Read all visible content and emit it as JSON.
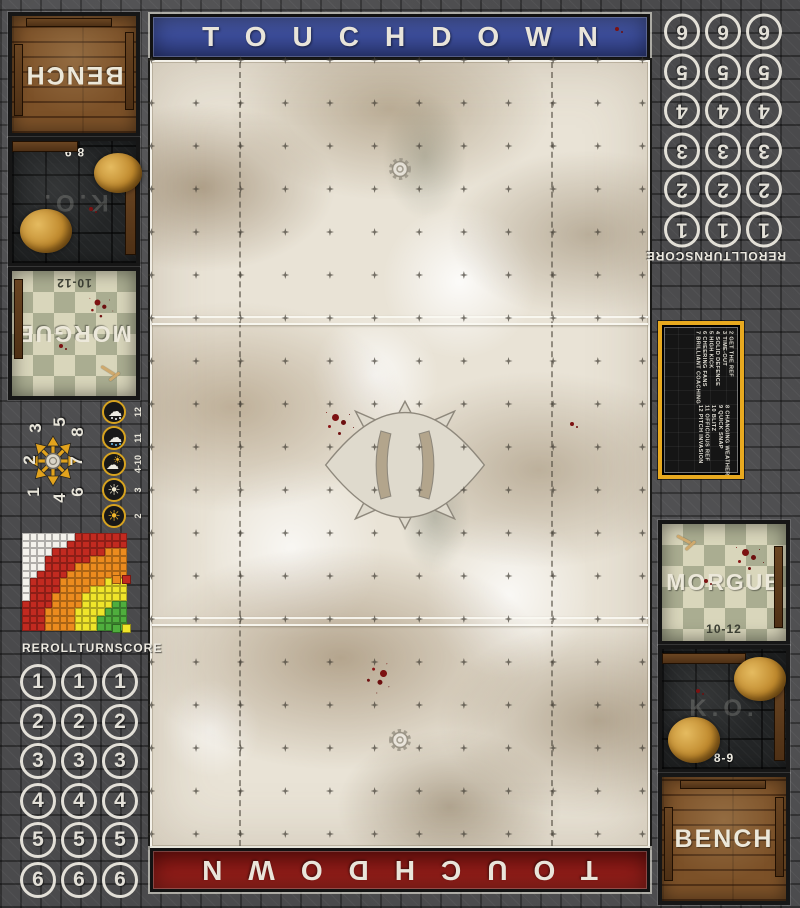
{
  "banners": {
    "top": {
      "label": "TOUCHDOWN",
      "color": "#3c4d9a"
    },
    "bottom": {
      "label": "TOUCHDOWN",
      "color": "#8d1b17"
    }
  },
  "dugouts": {
    "left": {
      "bench_label": "BENCH",
      "ko_label": "K.O.",
      "ko_range": "8-9",
      "morgue_label": "MORGUE",
      "morgue_range": "10-12"
    },
    "right": {
      "bench_label": "BENCH",
      "ko_label": "K.O.",
      "ko_range": "8-9",
      "morgue_label": "MORGUE",
      "morgue_range": "10-12"
    }
  },
  "tracks": {
    "heading": "REROLL TURN SCORE",
    "columns": [
      "REROLL",
      "TURN",
      "SCORE"
    ],
    "numbers": [
      1,
      2,
      3,
      4,
      5,
      6
    ]
  },
  "scatter": {
    "numbers": [
      1,
      2,
      3,
      4,
      5,
      6,
      7,
      8
    ]
  },
  "weather": {
    "rows": [
      {
        "range": "12",
        "icon": "snow-cloud"
      },
      {
        "range": "11",
        "icon": "rain-cloud"
      },
      {
        "range": "4-10",
        "icon": "sun-cloud"
      },
      {
        "range": "3",
        "icon": "sun"
      },
      {
        "range": "2",
        "icon": "sun-hot"
      }
    ]
  },
  "kickoff_table": {
    "groups": [
      [
        "2 GET THE REF",
        "3 TIME-OUT",
        "4 SOLID DEFENCE",
        "5 HIGH KICK",
        "6 CHEERING FANS",
        "7 BRILLIANT COACHING"
      ],
      [
        "8 CHANGING WEATHER",
        "9 QUICK SNAP",
        "10 BLITZ",
        "11 OFFICIOUS REF",
        "12 PITCH INVASION"
      ]
    ]
  },
  "range_ruler": {
    "cols": 14,
    "rows": 13,
    "bands": [
      {
        "name": "quick-pass",
        "color": "#4fae3d",
        "max": 3.4
      },
      {
        "name": "short-pass",
        "color": "#f0e52a",
        "max": 6.6
      },
      {
        "name": "long-pass",
        "color": "#ec8b1e",
        "max": 10.2
      },
      {
        "name": "long-bomb",
        "color": "#c22a20",
        "max": 13.6
      }
    ],
    "empty_color": "#f4f2ec",
    "legend_pairs": [
      [
        "#ec8b1e",
        "#c22a20"
      ],
      [
        "#4fae3d",
        "#f0e52a"
      ]
    ]
  },
  "field": {
    "grid_cols": 12,
    "grid_rows": 19,
    "line_rows": [
      6,
      13
    ]
  }
}
